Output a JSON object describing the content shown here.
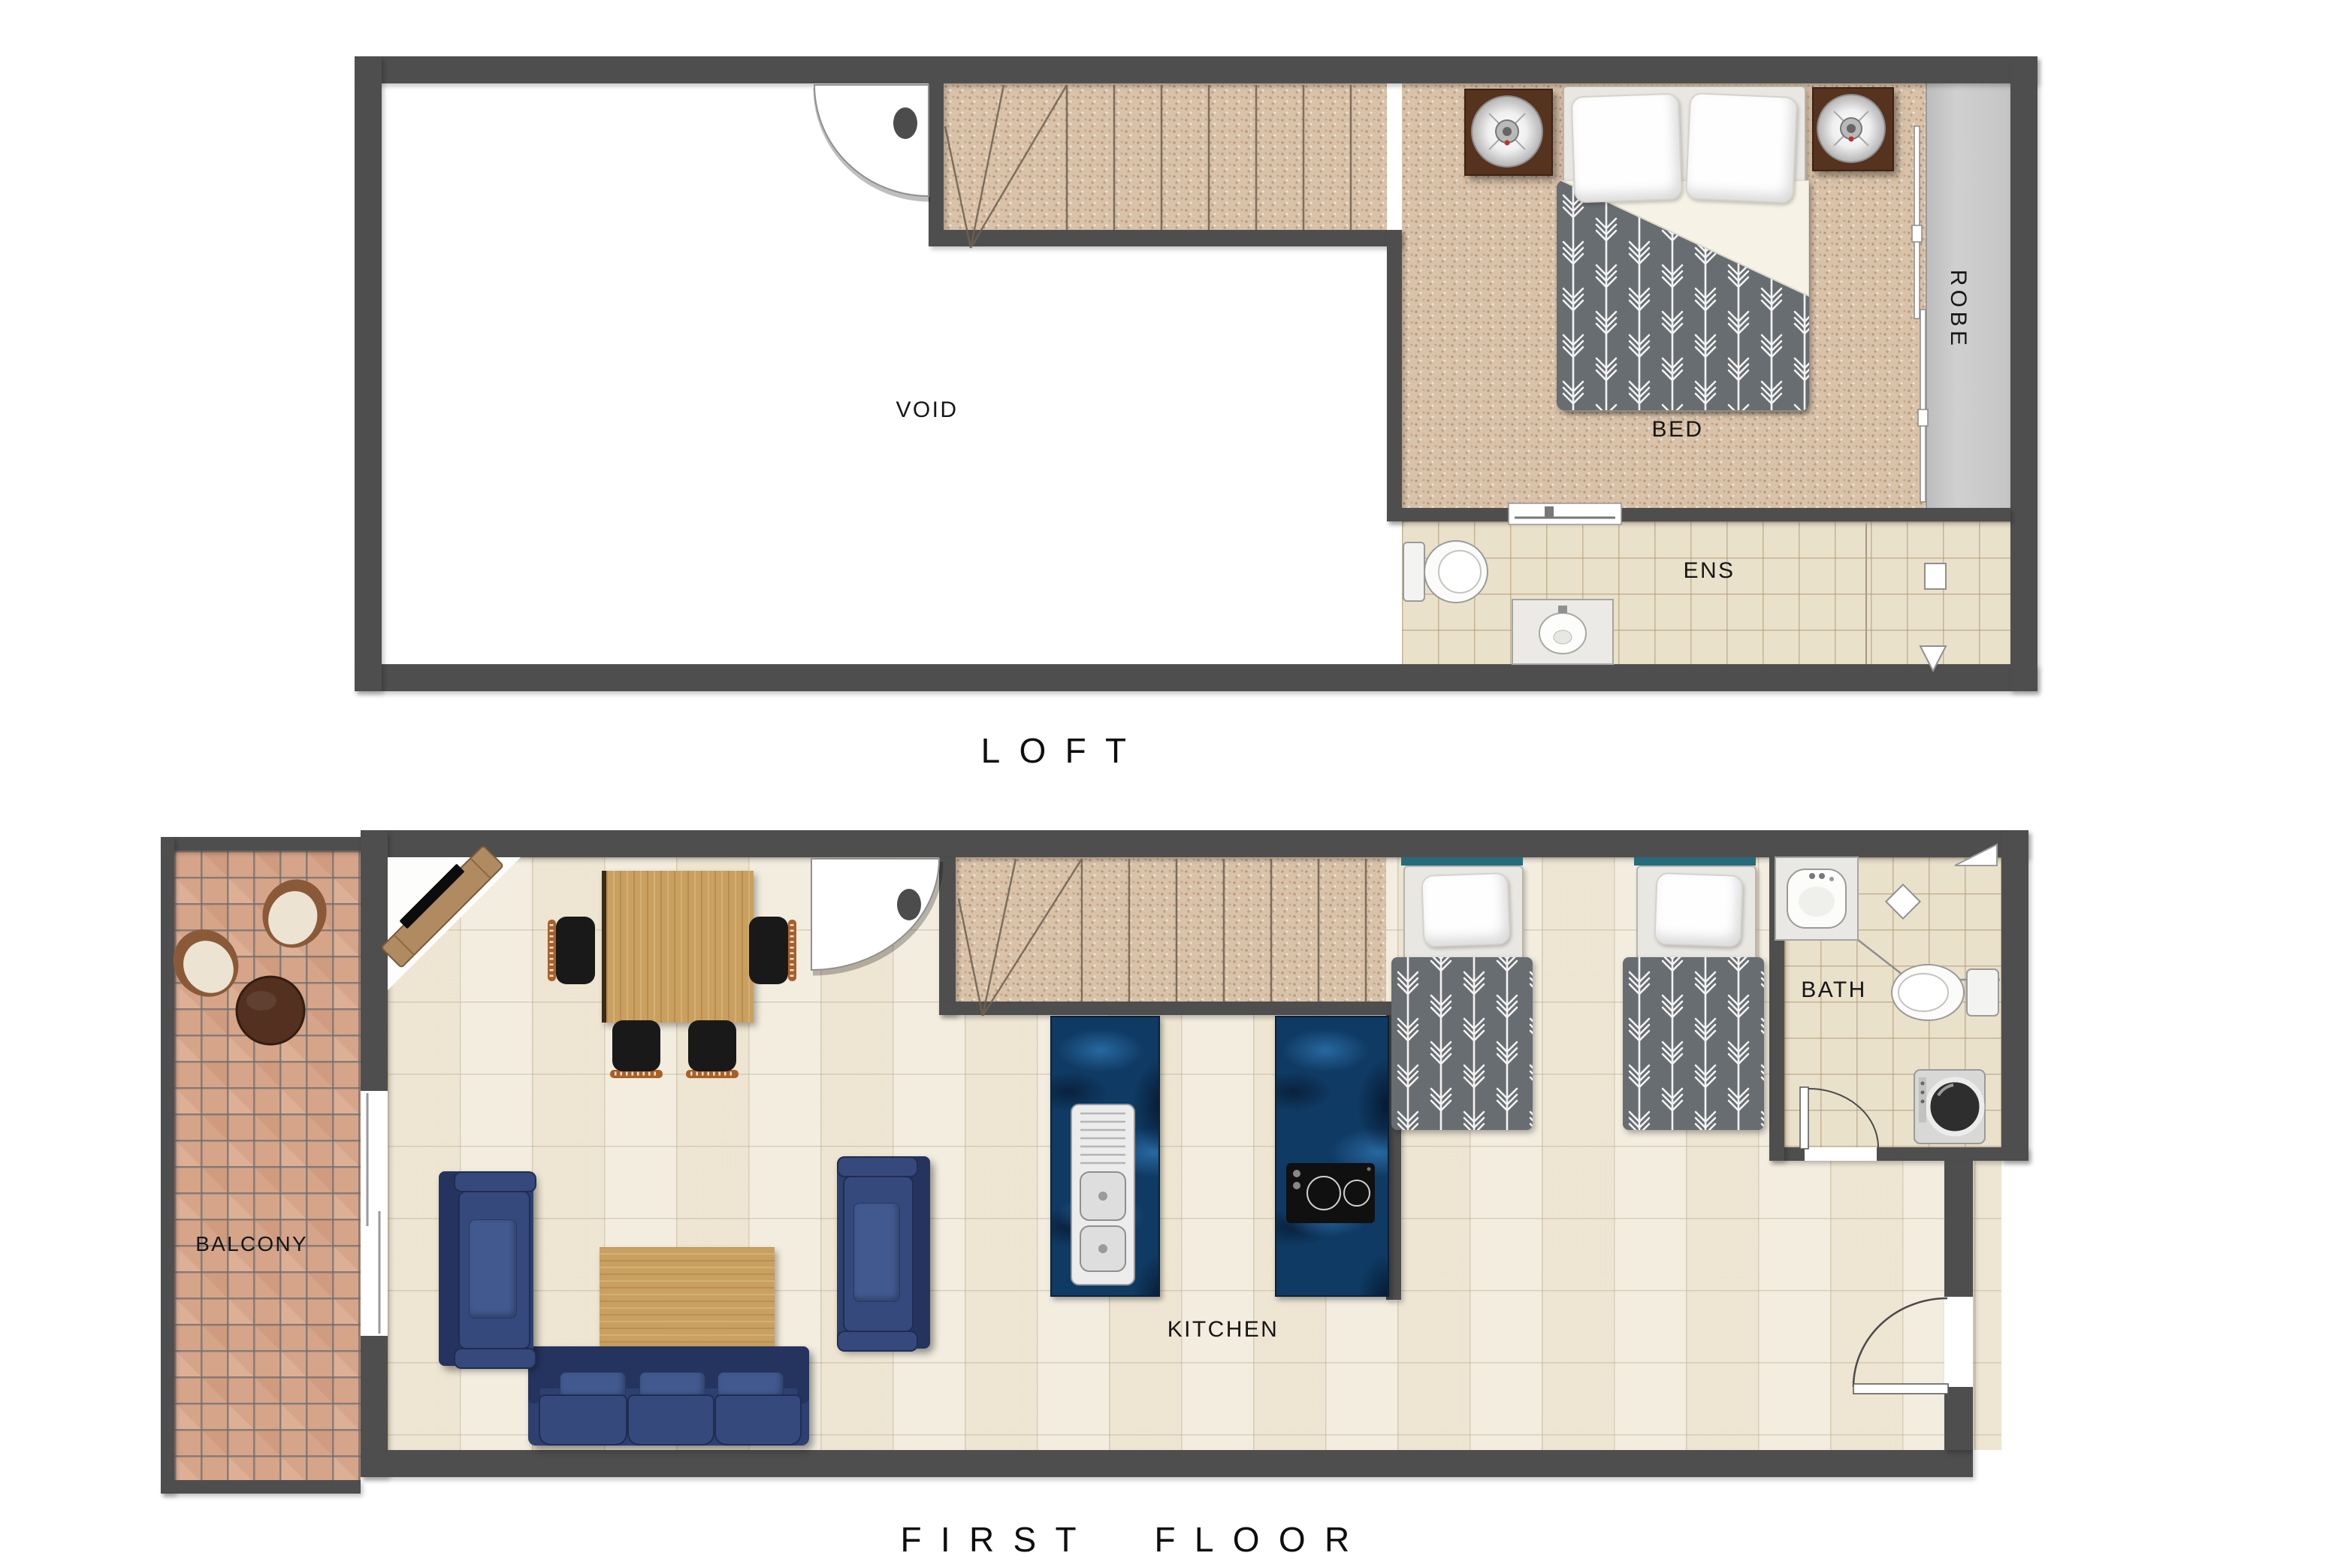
{
  "titles": {
    "loft": "LOFT",
    "first_floor": "FIRST FLOOR"
  },
  "labels": {
    "void": "VOID",
    "bed": "BED",
    "robe": "ROBE",
    "ens": "ENS",
    "balcony": "BALCONY",
    "kitchen": "KITCHEN",
    "bath": "BATH"
  },
  "colors": {
    "wall": "#4e4e4e",
    "carpet": "#d8c2a9",
    "floor_tile": "#f1ead9",
    "bath_tile": "#eae1cb",
    "balcony_tile": "#d6a489",
    "bench_marble": "#0f3a63",
    "sofa_blue": "#2d4070",
    "timber": "#c9a05f",
    "duvet_gray": "#686d71",
    "robe_gray": "#c5c5c5",
    "headboard_teal": "#256b7c",
    "chair_rust": "#a8602a"
  },
  "furniture": [
    "queen-bed",
    "bedside-table",
    "bedside-lamp",
    "built-in-robe",
    "toilet",
    "vanity-sink",
    "shower",
    "staircase",
    "swing-door",
    "sliding-door",
    "tv-unit",
    "dining-table",
    "dining-chair",
    "sofa",
    "armchair",
    "coffee-table",
    "island-sink-bench",
    "cooktop-bench",
    "single-bed",
    "bathroom-sink",
    "washing-machine",
    "balcony-chair",
    "balcony-table"
  ]
}
